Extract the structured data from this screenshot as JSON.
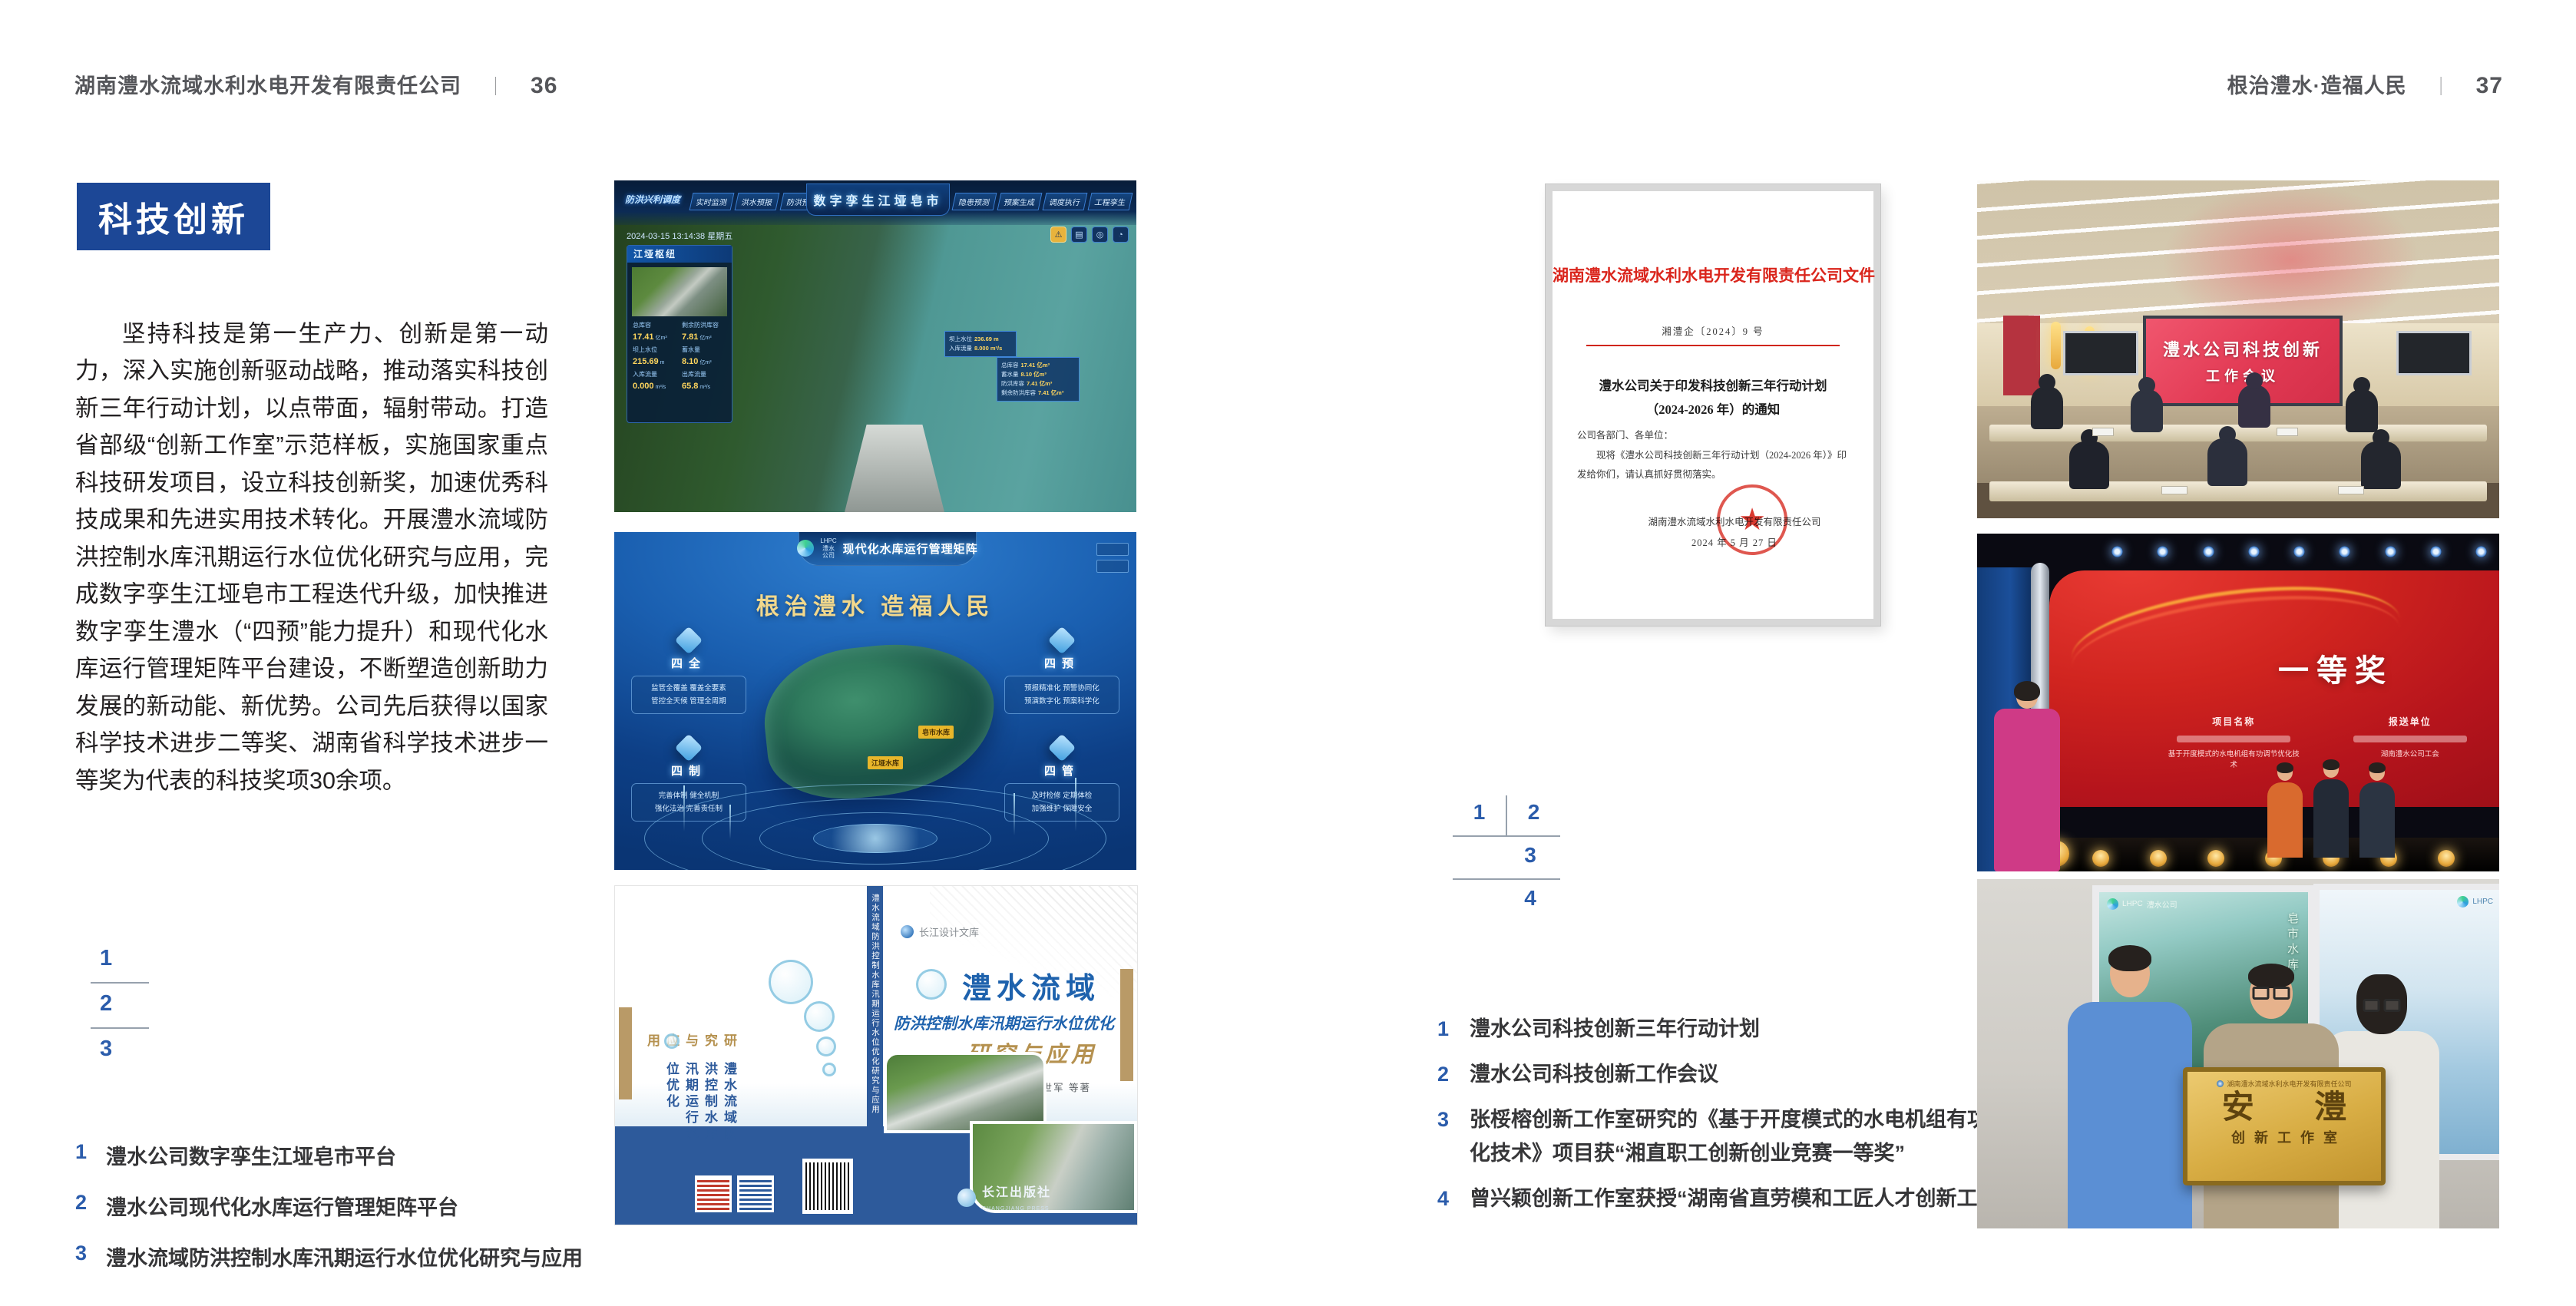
{
  "page_left": {
    "header": {
      "title": "湖南澧水流域水利水电开发有限责任公司",
      "separator": "｜",
      "page_number": "36"
    },
    "badge": "科技创新",
    "paragraph": "坚持科技是第一生产力、创新是第一动力，深入实施创新驱动战略，推动落实科技创新三年行动计划，以点带面，辐射带动。打造省部级“创新工作室”示范样板，实施国家重点科技研发项目，设立科技创新奖，加速优秀科技成果和先进实用技术转化。开展澧水流域防洪控制水库汛期运行水位优化研究与应用，完成数字孪生江垭皂市工程迭代升级，加快推进数字孪生澧水（“四预”能力提升）和现代化水库运行管理矩阵平台建设，不断塑造创新助力发展的新动能、新优势。公司先后获得以国家科学技术进步二等奖、湖南省科学技术进步一等奖为代表的科技奖项30余项。",
    "figure_index": [
      "1",
      "2",
      "3"
    ],
    "captions": [
      {
        "num": "1",
        "text": "澧水公司数字孪生江垭皂市平台"
      },
      {
        "num": "2",
        "text": "澧水公司现代化水库运行管理矩阵平台"
      },
      {
        "num": "3",
        "text": "澧水流域防洪控制水库汛期运行水位优化研究与应用"
      }
    ],
    "dashboard": {
      "title": "数字孪生江垭皂市",
      "corner_label": "防洪兴利调度",
      "tabs_left": [
        "实时监测",
        "洪水预报",
        "防洪预警"
      ],
      "tabs_right": [
        "隐患预测",
        "预案生成",
        "调度执行",
        "工程孪生"
      ],
      "timestamp": "2024-03-15 13:14:38 星期五",
      "panel_title": "江垭枢纽",
      "stats": [
        {
          "label": "总库容",
          "value": "17.41",
          "unit": "亿m³"
        },
        {
          "label": "剩余防洪库容",
          "value": "7.81",
          "unit": "亿m³"
        },
        {
          "label": "坝上水位",
          "value": "215.69",
          "unit": "m"
        },
        {
          "label": "蓄水量",
          "value": "8.10",
          "unit": "亿m³"
        },
        {
          "label": "入库流量",
          "value": "0.000",
          "unit": "m³/s"
        },
        {
          "label": "出库流量",
          "value": "65.8",
          "unit": "m³/s"
        }
      ],
      "popup1": [
        {
          "label": "坝上水位",
          "value": "236.69 m"
        },
        {
          "label": "入库流量",
          "value": "8.000 m³/s"
        }
      ],
      "popup2": [
        {
          "label": "总库容",
          "value": "17.41 亿m³"
        },
        {
          "label": "蓄水量",
          "value": "8.10 亿m³"
        },
        {
          "label": "防洪库容",
          "value": "7.41 亿m³"
        },
        {
          "label": "剩余防洪库容",
          "value": "7.41 亿m³"
        }
      ]
    },
    "matrix": {
      "brand": "LHPC",
      "brand_cn": "澧水公司",
      "header": "现代化水库运行管理矩阵",
      "slogan": "根治澧水 造福人民",
      "quadrants": [
        {
          "title": "四全",
          "line1": "监管全覆盖 覆盖全要素",
          "line2": "管控全天候 管理全周期"
        },
        {
          "title": "四预",
          "line1": "预报精准化 预警协同化",
          "line2": "预演数字化 预案科学化"
        },
        {
          "title": "四制",
          "line1": "完善体制 健全机制",
          "line2": "强化法治 完善责任制"
        },
        {
          "title": "四管",
          "line1": "及时检修 定期体检",
          "line2": "加强维护 保障安全"
        }
      ],
      "map_label1": "皂市水库",
      "map_label2": "江垭水库"
    },
    "book": {
      "series": "长江设计文库",
      "title_main": "澧水流域",
      "title_sub": "防洪控制水库汛期运行水位优化",
      "title_tail": "研究与应用",
      "authors": "洪兴骏 沈坤民 鲁军 刘世军 等著",
      "spine": "澧水流域防洪控制水库汛期运行水位优化研究与应用",
      "back_title_blue": "澧水流域防洪控制水库汛期运行水位优化",
      "back_title_gold": "研究与应用",
      "publisher": "长江出版社",
      "publisher_en": "CHANGJIANG PRESS"
    }
  },
  "page_right": {
    "header": {
      "title": "根治澧水·造福人民",
      "separator": "｜",
      "page_number": "37"
    },
    "document": {
      "red_header": "湖南澧水流域水利水电开发有限责任公司文件",
      "ref_no": "湘澧企〔2024〕9 号",
      "title_line1": "澧水公司关于印发科技创新三年行动计划",
      "title_line2": "（2024-2026 年）的通知",
      "salutation": "公司各部门、各单位：",
      "body": "现将《澧水公司科技创新三年行动计划（2024-2026 年）》印发给你们，请认真抓好贯彻落实。",
      "signer": "湖南澧水流域水利水电开发有限责任公司",
      "date": "2024 年 5 月 27 日"
    },
    "figure_index": [
      "1",
      "2",
      "3",
      "4"
    ],
    "captions": [
      {
        "num": "1",
        "text": "澧水公司科技创新三年行动计划"
      },
      {
        "num": "2",
        "text": "澧水公司科技创新工作会议"
      },
      {
        "num": "3",
        "text": "张桵榕创新工作室研究的《基于开度模式的水电机组有功调节优化技术》项目获“湘直职工创新创业竞赛一等奖”"
      },
      {
        "num": "4",
        "text": "曾兴颖创新工作室获授“湖南省直劳模和工匠人才创新工作室”"
      }
    ],
    "meeting": {
      "screen_line1": "澧水公司科技创新",
      "screen_line2": "工作会议"
    },
    "award": {
      "title": "一等奖",
      "col1_header": "项目名称",
      "col1_item": "基于开度模式的水电机组有功调节优化技术",
      "col2_header": "报送单位",
      "col2_item": "湖南澧水公司工会"
    },
    "plaque": {
      "brand": "LHPC",
      "brand_cn": "澧水公司",
      "poster_label": "皂市水库",
      "org_line": "湖南澧水流域水利水电开发有限责任公司",
      "main": "安 澧",
      "sub": "创新工作室"
    }
  }
}
